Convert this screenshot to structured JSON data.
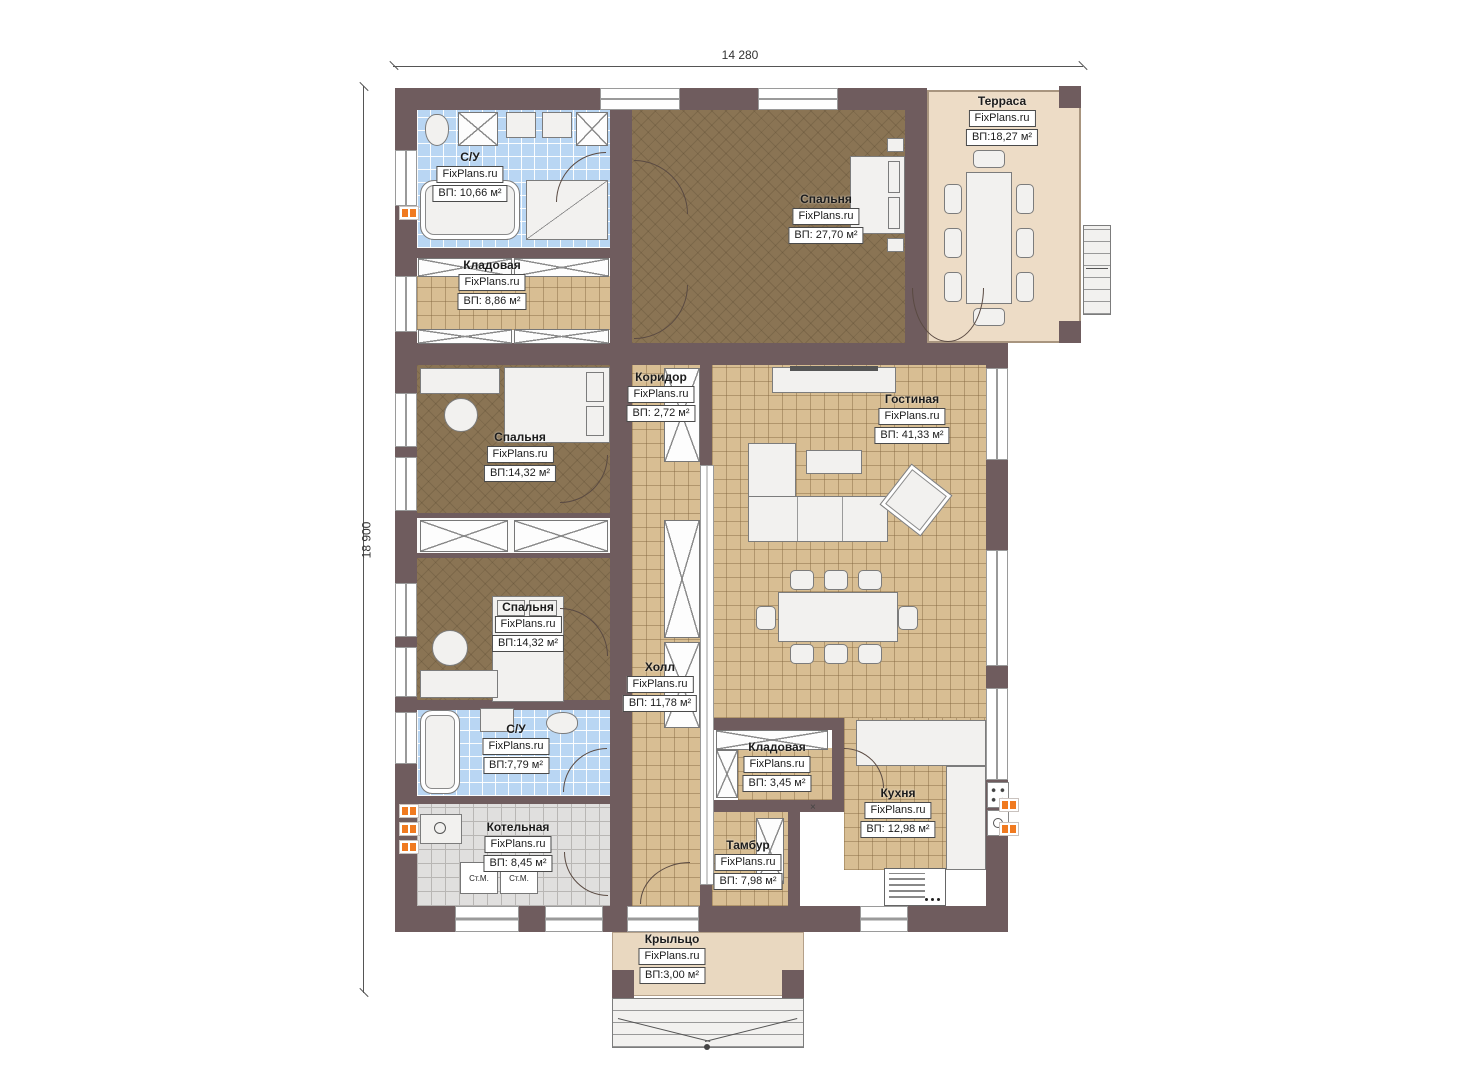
{
  "watermark": "FixPlans.ru",
  "dimensions": {
    "top": "14 280",
    "left": "18 900"
  },
  "rooms": {
    "terrace": {
      "name": "Терраса",
      "area": "ВП:18,27 м²"
    },
    "bedroom_top": {
      "name": "Спальня",
      "area": "ВП: 27,70 м²"
    },
    "bathroom_top": {
      "name": "С/У",
      "area": "ВП: 10,66 м²"
    },
    "storage_top": {
      "name": "Кладовая",
      "area": "ВП: 8,86 м²"
    },
    "corridor": {
      "name": "Коридор",
      "area": "ВП: 2,72 м²"
    },
    "living": {
      "name": "Гостиная",
      "area": "ВП: 41,33 м²"
    },
    "bedroom_mid": {
      "name": "Спальня",
      "area": "ВП:14,32 м²"
    },
    "bedroom_low": {
      "name": "Спальня",
      "area": "ВП:14,32 м²"
    },
    "hall": {
      "name": "Холл",
      "area": "ВП: 11,78 м²"
    },
    "bathroom_low": {
      "name": "С/У",
      "area": "ВП:7,79 м²"
    },
    "boiler": {
      "name": "Котельная",
      "area": "ВП: 8,45 м²"
    },
    "storage_small": {
      "name": "Кладовая",
      "area": "ВП: 3,45 м²"
    },
    "vestibule": {
      "name": "Тамбур",
      "area": "ВП: 7,98 м²"
    },
    "kitchen": {
      "name": "Кухня",
      "area": "ВП: 12,98 м²"
    },
    "porch": {
      "name": "Крыльцо",
      "area": "ВП:3,00 м²"
    }
  },
  "appliances": {
    "washer1": "Ст.М.",
    "washer2": "Ст.М."
  },
  "symbols": {
    "cross": "×"
  },
  "colors": {
    "wall": "#6f5c5e",
    "floor_tan": "#d8be93",
    "floor_brown": "#8a7454",
    "floor_blue": "#b9d6f3",
    "floor_gray": "#e0dfde",
    "terrace": "#eddcc6",
    "porch": "#e9d8c0",
    "radiator": "#f07a20"
  }
}
